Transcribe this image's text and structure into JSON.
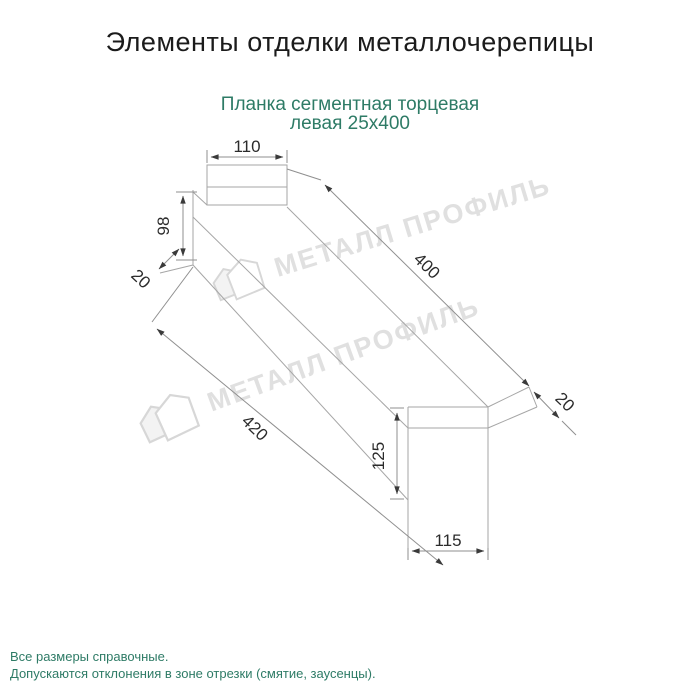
{
  "header": {
    "title": "Элементы отделки металлочерепицы"
  },
  "product": {
    "subtitle_line1": "Планка сегментная торцевая",
    "subtitle_line2": "левая 25х400"
  },
  "drawing": {
    "type": "axonometric profile drawing",
    "dimensions": {
      "top_width": "110",
      "left_height": "98",
      "left_hem": "20",
      "length_top": "400",
      "length_bottom": "420",
      "right_hem": "20",
      "right_height": "125",
      "right_width": "115"
    }
  },
  "watermark": {
    "text": "МЕТАЛЛ ПРОФИЛЬ"
  },
  "footer": {
    "line1": "Все размеры справочные.",
    "line2": "Допускаются отклонения в зоне отрезки (смятие, заусенцы)."
  },
  "colors": {
    "accent_teal": "#2e7b66",
    "title_black": "#1b1b1b",
    "outline_gray": "#a6a6a6",
    "dimension_gray": "#8f8f8f",
    "dimension_text": "#2b2b2b",
    "watermark_gray": "#e0e0e0"
  }
}
